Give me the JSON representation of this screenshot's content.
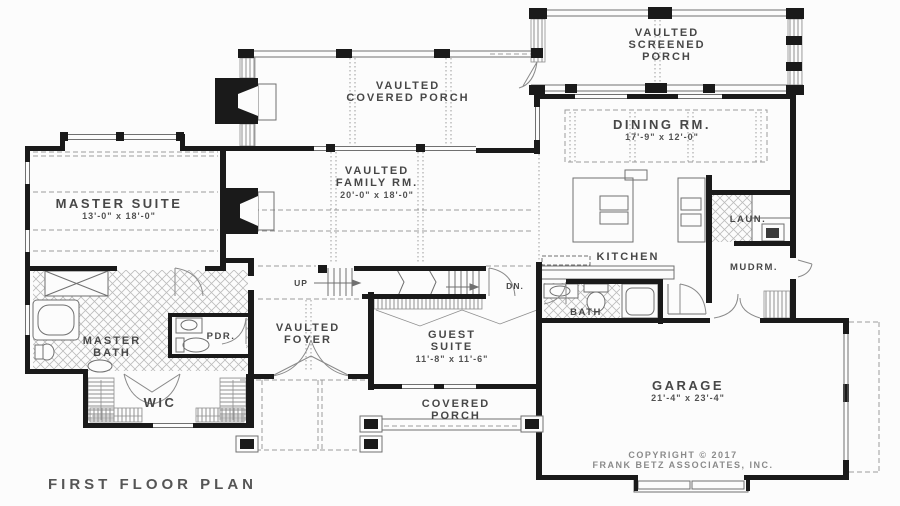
{
  "plan": {
    "title": "FIRST FLOOR PLAN",
    "copyright": {
      "line1": "COPYRIGHT © 2017",
      "line2": "FRANK BETZ ASSOCIATES, INC."
    },
    "stairs": {
      "up": "UP",
      "down": "DN."
    },
    "rooms": {
      "screened_porch": {
        "line1": "VAULTED",
        "line2": "SCREENED",
        "line3": "PORCH"
      },
      "covered_porch_top": {
        "line1": "VAULTED",
        "line2": "COVERED PORCH"
      },
      "dining": {
        "name": "DINING RM.",
        "dims": "17'-9\" x 12'-0\""
      },
      "family": {
        "line1": "VAULTED",
        "line2": "FAMILY RM.",
        "dims": "20'-0\" x 18'-0\""
      },
      "master_suite": {
        "name": "MASTER SUITE",
        "dims": "13'-0\" x 18'-0\""
      },
      "kitchen": {
        "name": "KITCHEN"
      },
      "laundry": {
        "name": "LAUN."
      },
      "mudroom": {
        "name": "MUDRM."
      },
      "master_bath": {
        "line1": "MASTER",
        "line2": "BATH"
      },
      "powder": {
        "name": "PDR."
      },
      "foyer": {
        "line1": "VAULTED",
        "line2": "FOYER"
      },
      "guest_suite": {
        "line1": "GUEST",
        "line2": "SUITE",
        "dims": "11'-8\" x 11'-6\""
      },
      "bath": {
        "name": "BATH"
      },
      "wic": {
        "name": "WIC"
      },
      "covered_porch_bottom": {
        "line1": "COVERED",
        "line2": "PORCH"
      },
      "garage": {
        "name": "GARAGE",
        "dims": "21'-4\" x 23'-4\""
      }
    },
    "colors": {
      "wall": "#1a1a1a",
      "line": "#707070",
      "dash": "#9b9b9b",
      "hatch": "#bcbcbc",
      "text": "#474747",
      "bg": "#fcfcfc"
    }
  }
}
